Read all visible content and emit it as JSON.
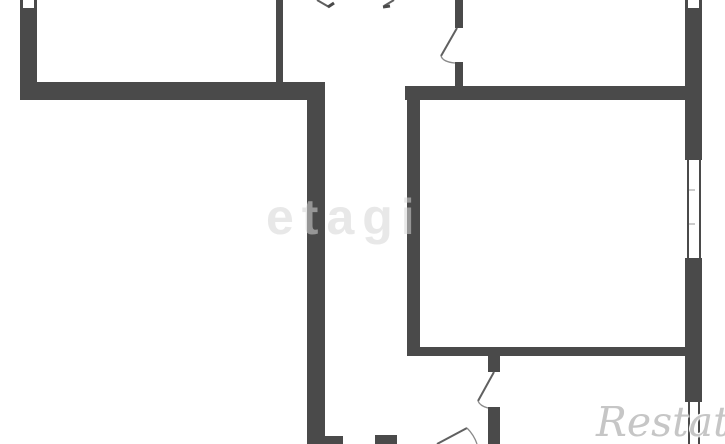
{
  "watermarks": {
    "center": "etagi",
    "corner": "Restate"
  },
  "colors": {
    "background": "#ffffff",
    "wall": "#4a4a4a",
    "door_line": "#606060",
    "door_arc": "#8a8a8a",
    "window_tick": "#a8a8a8",
    "watermark_center": "#d6d6d6",
    "watermark_corner": "#c6c6c6"
  }
}
